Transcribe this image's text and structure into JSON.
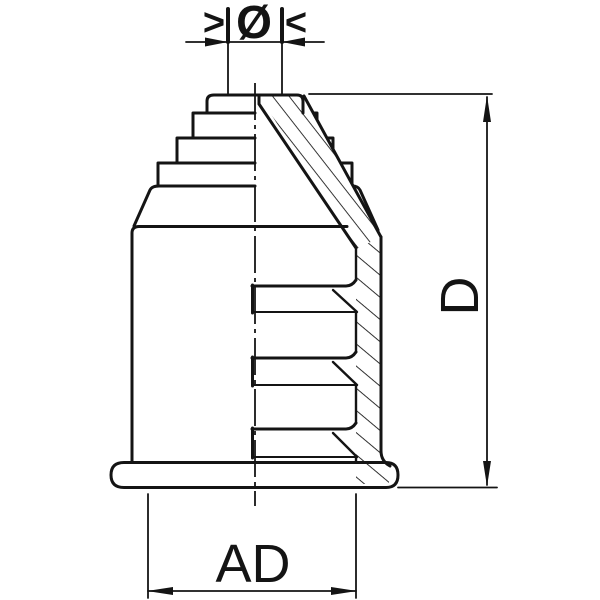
{
  "drawing": {
    "type": "technical-section-drawing",
    "description": "Sectioned protective cap with stepped conical top, internal gripping teeth and base flange",
    "colors": {
      "line": "#141414",
      "background": "#ffffff"
    },
    "labels": {
      "clamp_left_arrow": ">",
      "clamp_diameter_symbol": "Ø",
      "clamp_right_arrow": "<",
      "height_dimension": "D",
      "width_dimension": "AD"
    }
  }
}
